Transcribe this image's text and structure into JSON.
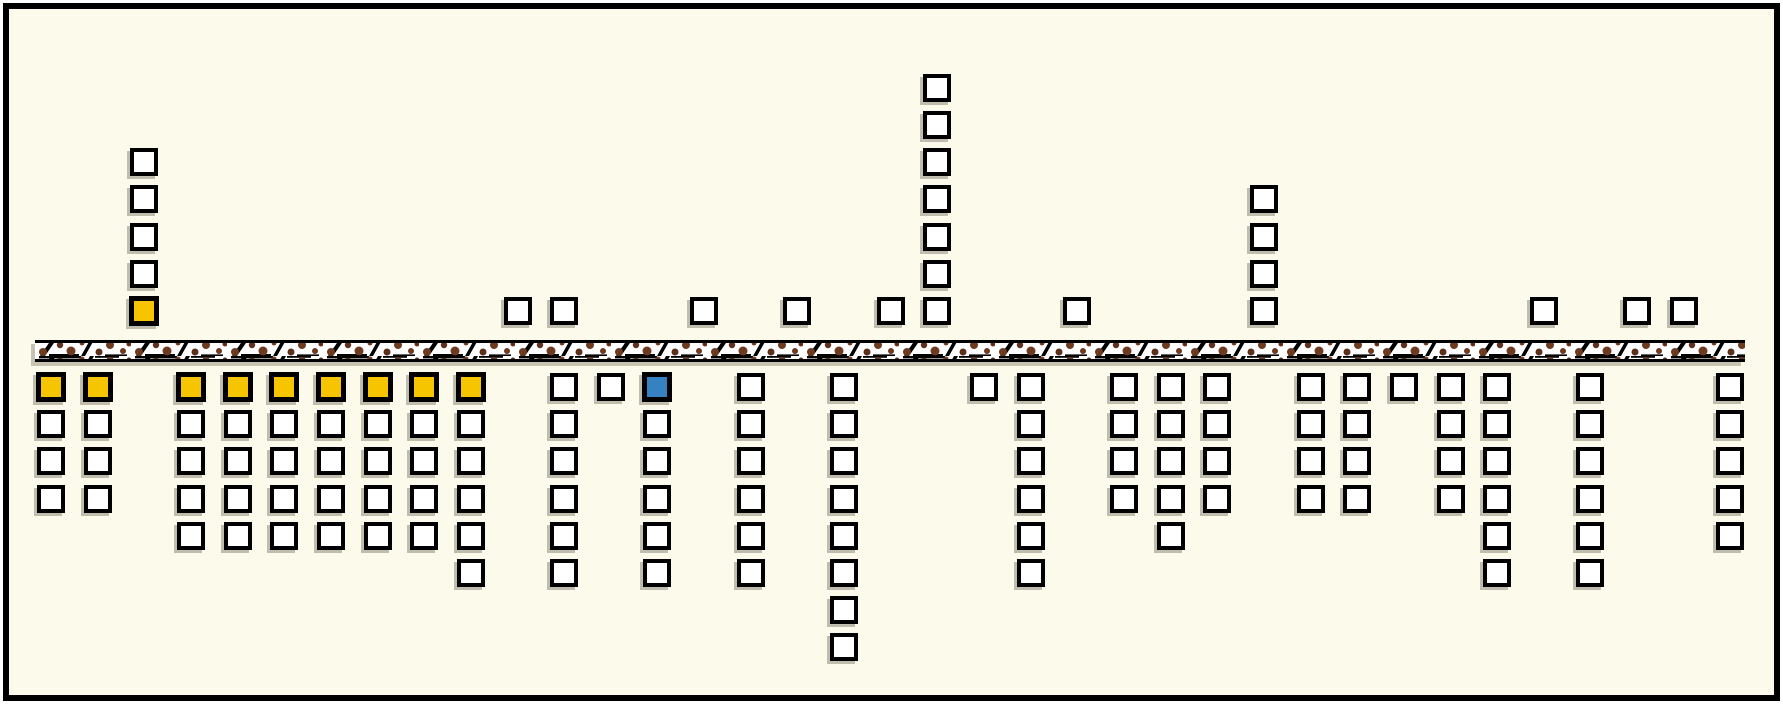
{
  "scene": {
    "page_background": "#ffffff",
    "field_background": "#FCFAEA",
    "frame_border_color": "#000000",
    "frame_border_px": 6
  },
  "palette": {
    "white": "#ffffff",
    "yellow": "#F7C500",
    "blue": "#3581C1",
    "outline": "#000000",
    "shadow": "#c1bdac",
    "road_dot_brown": "#6E3A1E",
    "road_dot_brown_dark": "#5E2F18",
    "road_base": "#ffffff",
    "road_edge": "#000000"
  },
  "grid": {
    "col0_x": 37,
    "col_width": 46.65,
    "square_outer_size": 28,
    "row_spacing": 37.2,
    "above_row0_top": 297,
    "below_row0_top": 373
  },
  "road": {
    "x": 35,
    "y": 340,
    "width": 1710,
    "height": 22,
    "edge_thickness": 3
  },
  "stacks_above": [
    {
      "col": 2,
      "cells_bottom_to_top": [
        "yellow",
        "white",
        "white",
        "white",
        "white"
      ]
    },
    {
      "col": 10,
      "cells_bottom_to_top": [
        "white"
      ]
    },
    {
      "col": 11,
      "cells_bottom_to_top": [
        "white"
      ]
    },
    {
      "col": 14,
      "cells_bottom_to_top": [
        "white"
      ]
    },
    {
      "col": 16,
      "cells_bottom_to_top": [
        "white"
      ]
    },
    {
      "col": 18,
      "cells_bottom_to_top": [
        "white"
      ]
    },
    {
      "col": 19,
      "cells_bottom_to_top": [
        "white",
        "white",
        "white",
        "white",
        "white",
        "white",
        "white"
      ]
    },
    {
      "col": 22,
      "cells_bottom_to_top": [
        "white"
      ]
    },
    {
      "col": 26,
      "cells_bottom_to_top": [
        "white",
        "white",
        "white",
        "white"
      ]
    },
    {
      "col": 32,
      "cells_bottom_to_top": [
        "white"
      ]
    },
    {
      "col": 34,
      "cells_bottom_to_top": [
        "white"
      ]
    },
    {
      "col": 35,
      "cells_bottom_to_top": [
        "white"
      ]
    }
  ],
  "stacks_below": [
    {
      "col": 0,
      "cells_top_to_bottom": [
        "yellow",
        "white",
        "white",
        "white"
      ]
    },
    {
      "col": 1,
      "cells_top_to_bottom": [
        "yellow",
        "white",
        "white",
        "white"
      ]
    },
    {
      "col": 3,
      "cells_top_to_bottom": [
        "yellow",
        "white",
        "white",
        "white",
        "white"
      ]
    },
    {
      "col": 4,
      "cells_top_to_bottom": [
        "yellow",
        "white",
        "white",
        "white",
        "white"
      ]
    },
    {
      "col": 5,
      "cells_top_to_bottom": [
        "yellow",
        "white",
        "white",
        "white",
        "white"
      ]
    },
    {
      "col": 6,
      "cells_top_to_bottom": [
        "yellow",
        "white",
        "white",
        "white",
        "white"
      ]
    },
    {
      "col": 7,
      "cells_top_to_bottom": [
        "yellow",
        "white",
        "white",
        "white",
        "white"
      ]
    },
    {
      "col": 8,
      "cells_top_to_bottom": [
        "yellow",
        "white",
        "white",
        "white",
        "white"
      ]
    },
    {
      "col": 9,
      "cells_top_to_bottom": [
        "yellow",
        "white",
        "white",
        "white",
        "white",
        "white"
      ]
    },
    {
      "col": 11,
      "cells_top_to_bottom": [
        "white",
        "white",
        "white",
        "white",
        "white",
        "white"
      ]
    },
    {
      "col": 12,
      "cells_top_to_bottom": [
        "white"
      ]
    },
    {
      "col": 13,
      "cells_top_to_bottom": [
        "blue",
        "white",
        "white",
        "white",
        "white",
        "white"
      ]
    },
    {
      "col": 15,
      "cells_top_to_bottom": [
        "white",
        "white",
        "white",
        "white",
        "white",
        "white"
      ]
    },
    {
      "col": 17,
      "cells_top_to_bottom": [
        "white",
        "white",
        "white",
        "white",
        "white",
        "white",
        "white",
        "white"
      ]
    },
    {
      "col": 20,
      "cells_top_to_bottom": [
        "white"
      ]
    },
    {
      "col": 21,
      "cells_top_to_bottom": [
        "white",
        "white",
        "white",
        "white",
        "white",
        "white"
      ]
    },
    {
      "col": 23,
      "cells_top_to_bottom": [
        "white",
        "white",
        "white",
        "white"
      ]
    },
    {
      "col": 24,
      "cells_top_to_bottom": [
        "white",
        "white",
        "white",
        "white",
        "white"
      ]
    },
    {
      "col": 25,
      "cells_top_to_bottom": [
        "white",
        "white",
        "white",
        "white"
      ]
    },
    {
      "col": 27,
      "cells_top_to_bottom": [
        "white",
        "white",
        "white",
        "white"
      ]
    },
    {
      "col": 28,
      "cells_top_to_bottom": [
        "white",
        "white",
        "white",
        "white"
      ]
    },
    {
      "col": 29,
      "cells_top_to_bottom": [
        "white"
      ]
    },
    {
      "col": 30,
      "cells_top_to_bottom": [
        "white",
        "white",
        "white",
        "white"
      ]
    },
    {
      "col": 31,
      "cells_top_to_bottom": [
        "white",
        "white",
        "white",
        "white",
        "white",
        "white"
      ]
    },
    {
      "col": 33,
      "cells_top_to_bottom": [
        "white",
        "white",
        "white",
        "white",
        "white",
        "white"
      ]
    },
    {
      "col": 36,
      "cells_top_to_bottom": [
        "white",
        "white",
        "white",
        "white",
        "white"
      ]
    }
  ]
}
